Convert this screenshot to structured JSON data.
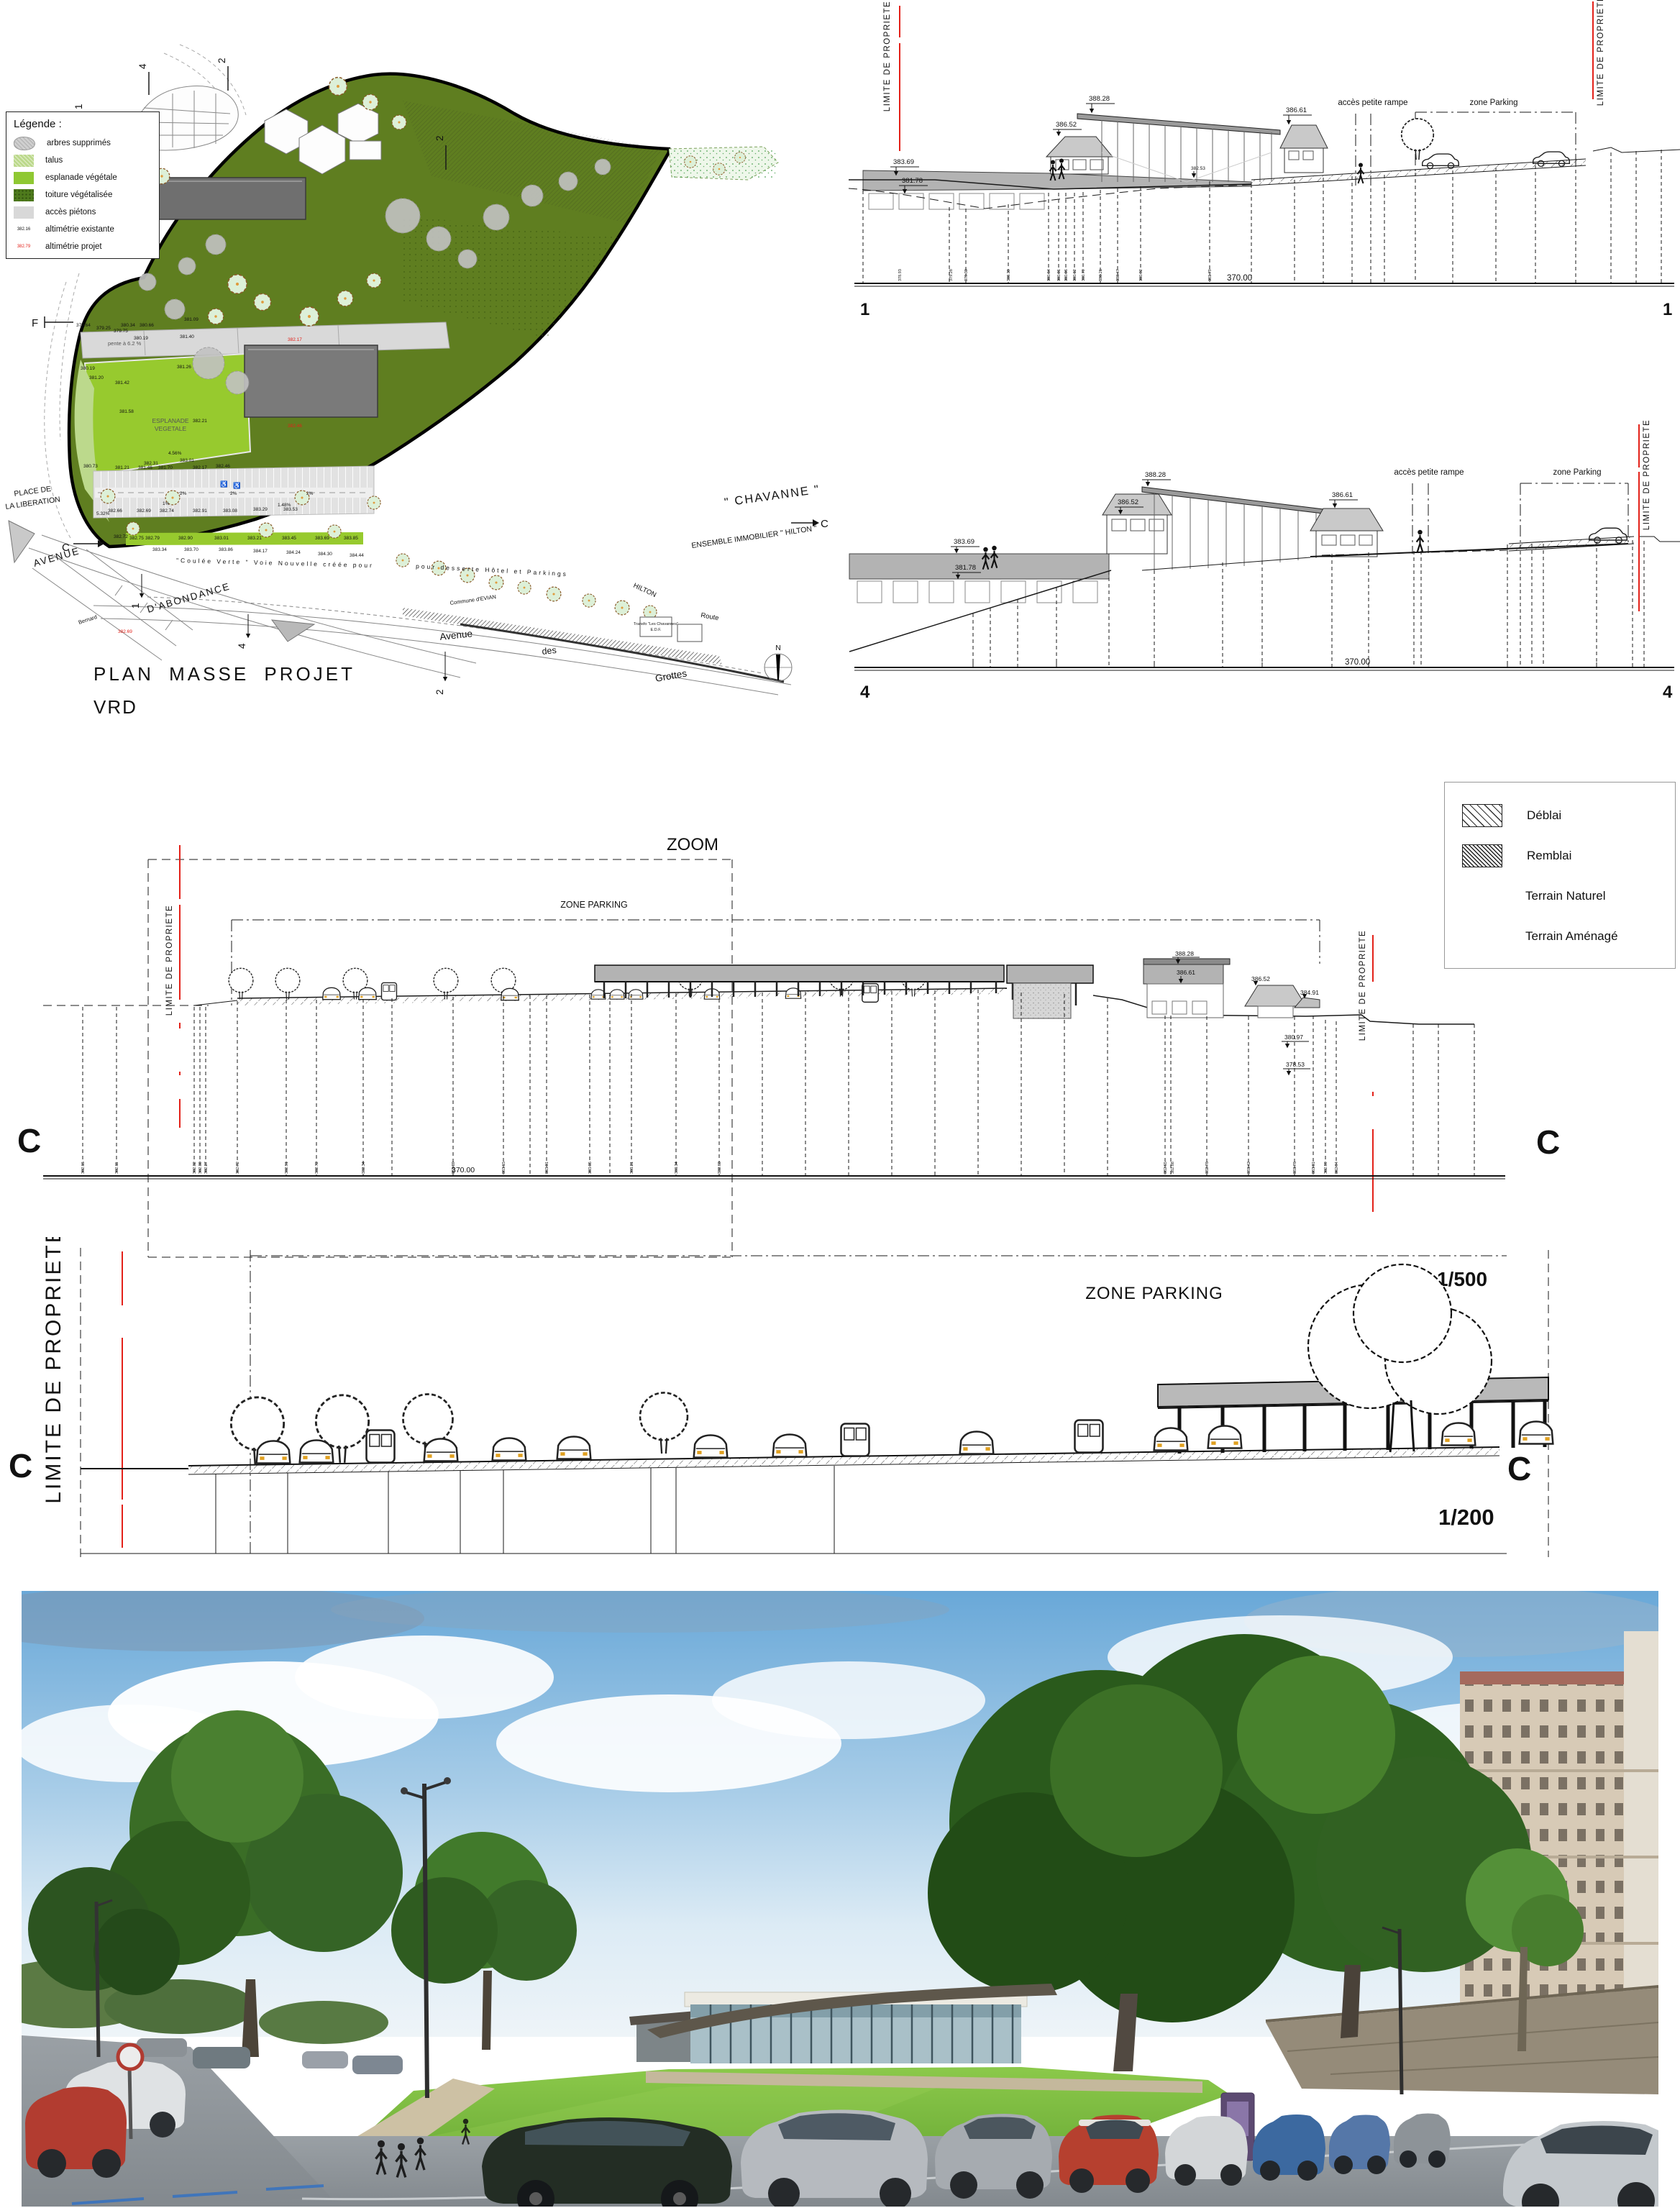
{
  "plan": {
    "title": "PLAN MASSE PROJET",
    "subtitle": "VRD",
    "legend": {
      "title": "Légende :",
      "items": [
        {
          "label": "arbres supprimés"
        },
        {
          "label": "talus"
        },
        {
          "label": "esplanade végétale"
        },
        {
          "label": "toiture végétalisée"
        },
        {
          "label": "accès piétons"
        },
        {
          "label": "altimétrie existante",
          "sample": "382.16"
        },
        {
          "label": "altimétrie projet",
          "sample": "382.79"
        }
      ]
    },
    "labels": {
      "place1": "PLACE DE",
      "place2": "LA LIBERATION",
      "avenue": "AVENUE",
      "abondance": "D'ABONDANCE",
      "avenue2": "Avenue",
      "des": "des",
      "grottes": "Grottes",
      "commune": "Commune d'EVIAN",
      "coulee": "\"Coulée   Verte \"   Voie   Nouvelle   créée   pour",
      "desserte": "pour   desserte   Hôtel   et   Parkings",
      "hilton": "HILTON",
      "route": "Route",
      "bernard": "Bernard",
      "esplanade1": "ESPLANADE",
      "esplanade2": "VEGETALE",
      "pente": "pente à 6.2 %",
      "chavanne": "\" CHAVANNE \"",
      "ensemble": "ENSEMBLE IMMOBILIER \" HILTON \"",
      "transfo1": "Transfo \"Les Chavannes\"",
      "transfo2": "E.D.F.",
      "north": "N"
    },
    "markers": {
      "f": "F",
      "c": "C",
      "m1": "1",
      "m2": "2",
      "m4": "4"
    },
    "percents": [
      "2%",
      "2%",
      "1.48%",
      "2%",
      "1%",
      "5.32%",
      "4.56%"
    ],
    "spot_black": [
      "379.64",
      "379.25",
      "379.75",
      "380.19",
      "381.09",
      "381.20",
      "381.42",
      "381.58",
      "381.26",
      "382.21",
      "382.31",
      "383.01",
      "382.69",
      "383.34",
      "383.70",
      "383.86",
      "384.17",
      "384.24",
      "384.30",
      "384.44"
    ],
    "spot_red": [
      "380.34",
      "380.66",
      "381.40",
      "380.19",
      "380.73",
      "381.21",
      "381.46",
      "381.70",
      "382.17",
      "382.46",
      "382.66",
      "382.69",
      "382.74",
      "382.91",
      "383.08",
      "383.29",
      "383.53",
      "382.72",
      "382.75",
      "382.79",
      "382.90",
      "383.01",
      "383.21",
      "383.45",
      "383.69",
      "383.85",
      "382.69"
    ]
  },
  "sections": {
    "limite": "LIMITE DE PROPRIETE",
    "s1": {
      "marker": "1",
      "length": "370.00",
      "rampe": "accès petite rampe",
      "parking": "zone Parking",
      "elev": {
        "e1": "383.69",
        "e2": "381.78",
        "e3": "386.52",
        "e4": "388.28",
        "e5": "386.61",
        "e6": "382.53"
      },
      "base": [
        "378.93",
        "379.28",
        "379.30",
        "380.39",
        "380.64",
        "380.01",
        "380.06",
        "380.12",
        "380.79",
        "380.21",
        "380.47",
        "380.92",
        "381.79"
      ]
    },
    "s4": {
      "marker": "4",
      "length": "370.00",
      "rampe": "accès petite rampe",
      "parking": "zone Parking",
      "elev": {
        "e1": "383.69",
        "e2": "381.78",
        "e3": "386.52",
        "e4": "388.28",
        "e5": "386.61"
      }
    },
    "c500": {
      "zoom": "ZOOM",
      "zone": "ZONE PARKING",
      "marker": "C",
      "scale": "1/500",
      "length": "370.00",
      "elev": {
        "e1": "388.28",
        "e2": "386.61",
        "e3": "386.52",
        "e4": "384.91",
        "e5": "380.97",
        "e6": "378.53"
      },
      "base": [
        "382.15",
        "382.11",
        "382.32",
        "382.30",
        "382.27",
        "382.72",
        "382.91",
        "382.72",
        "382.34",
        "383.39",
        "383.15",
        "383.01",
        "383.35",
        "383.21",
        "383.34",
        "382.63",
        "382.65",
        "382.88",
        "382.76",
        "383.42",
        "383.76",
        "383.01",
        "382.99",
        "382.94"
      ]
    },
    "c200": {
      "zone": "ZONE PARKING",
      "marker": "C",
      "scale": "1/200"
    }
  },
  "cut_legend": {
    "deblai": "Déblai",
    "remblai": "Remblai",
    "naturel": "Terrain Naturel",
    "amenage": "Terrain Aménagé"
  }
}
